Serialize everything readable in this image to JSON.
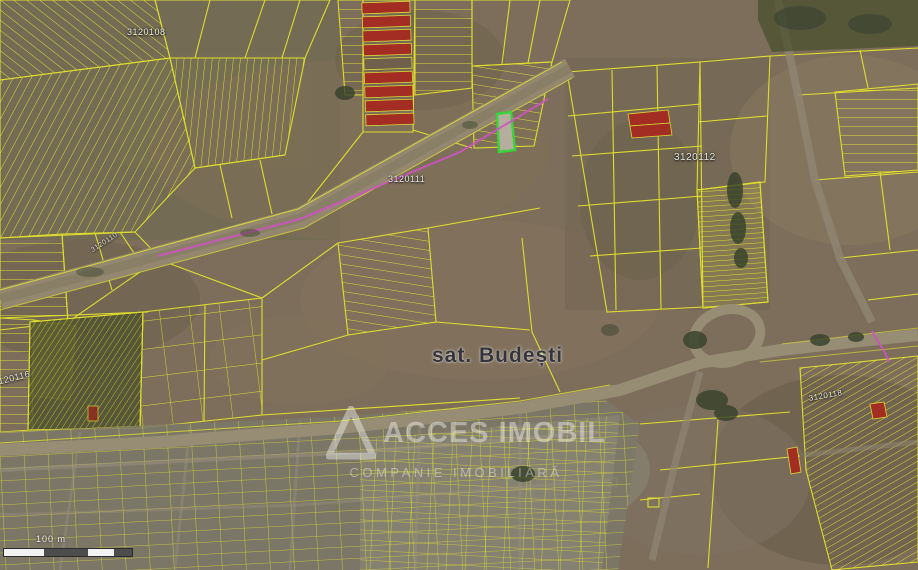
{
  "app": {
    "type": "cadastral-map-viewer"
  },
  "map": {
    "place_label": "sat. Budești",
    "cadastral_labels": [
      {
        "id": "sector-1",
        "text": "3120108"
      },
      {
        "id": "sector-2",
        "text": "3120111"
      },
      {
        "id": "sector-3",
        "text": "3120112"
      },
      {
        "id": "sector-4",
        "text": "3120110"
      },
      {
        "id": "sector-5",
        "text": "3120116"
      },
      {
        "id": "sector-6",
        "text": "3120118"
      }
    ],
    "scale_bar": {
      "label": "100 m"
    },
    "watermark": {
      "title": "ACCES IMOBIL",
      "subtitle": "COMPANIE IMOBILIARĂ"
    },
    "colors": {
      "parcel_line": "#e4e42c",
      "highlight_parcel_border": "#38d438",
      "red_parcel_fill": "#a32d22",
      "route_line": "#cf52c4",
      "terrain_base": "#7c6e5b",
      "road_fill": "#968b74"
    }
  }
}
